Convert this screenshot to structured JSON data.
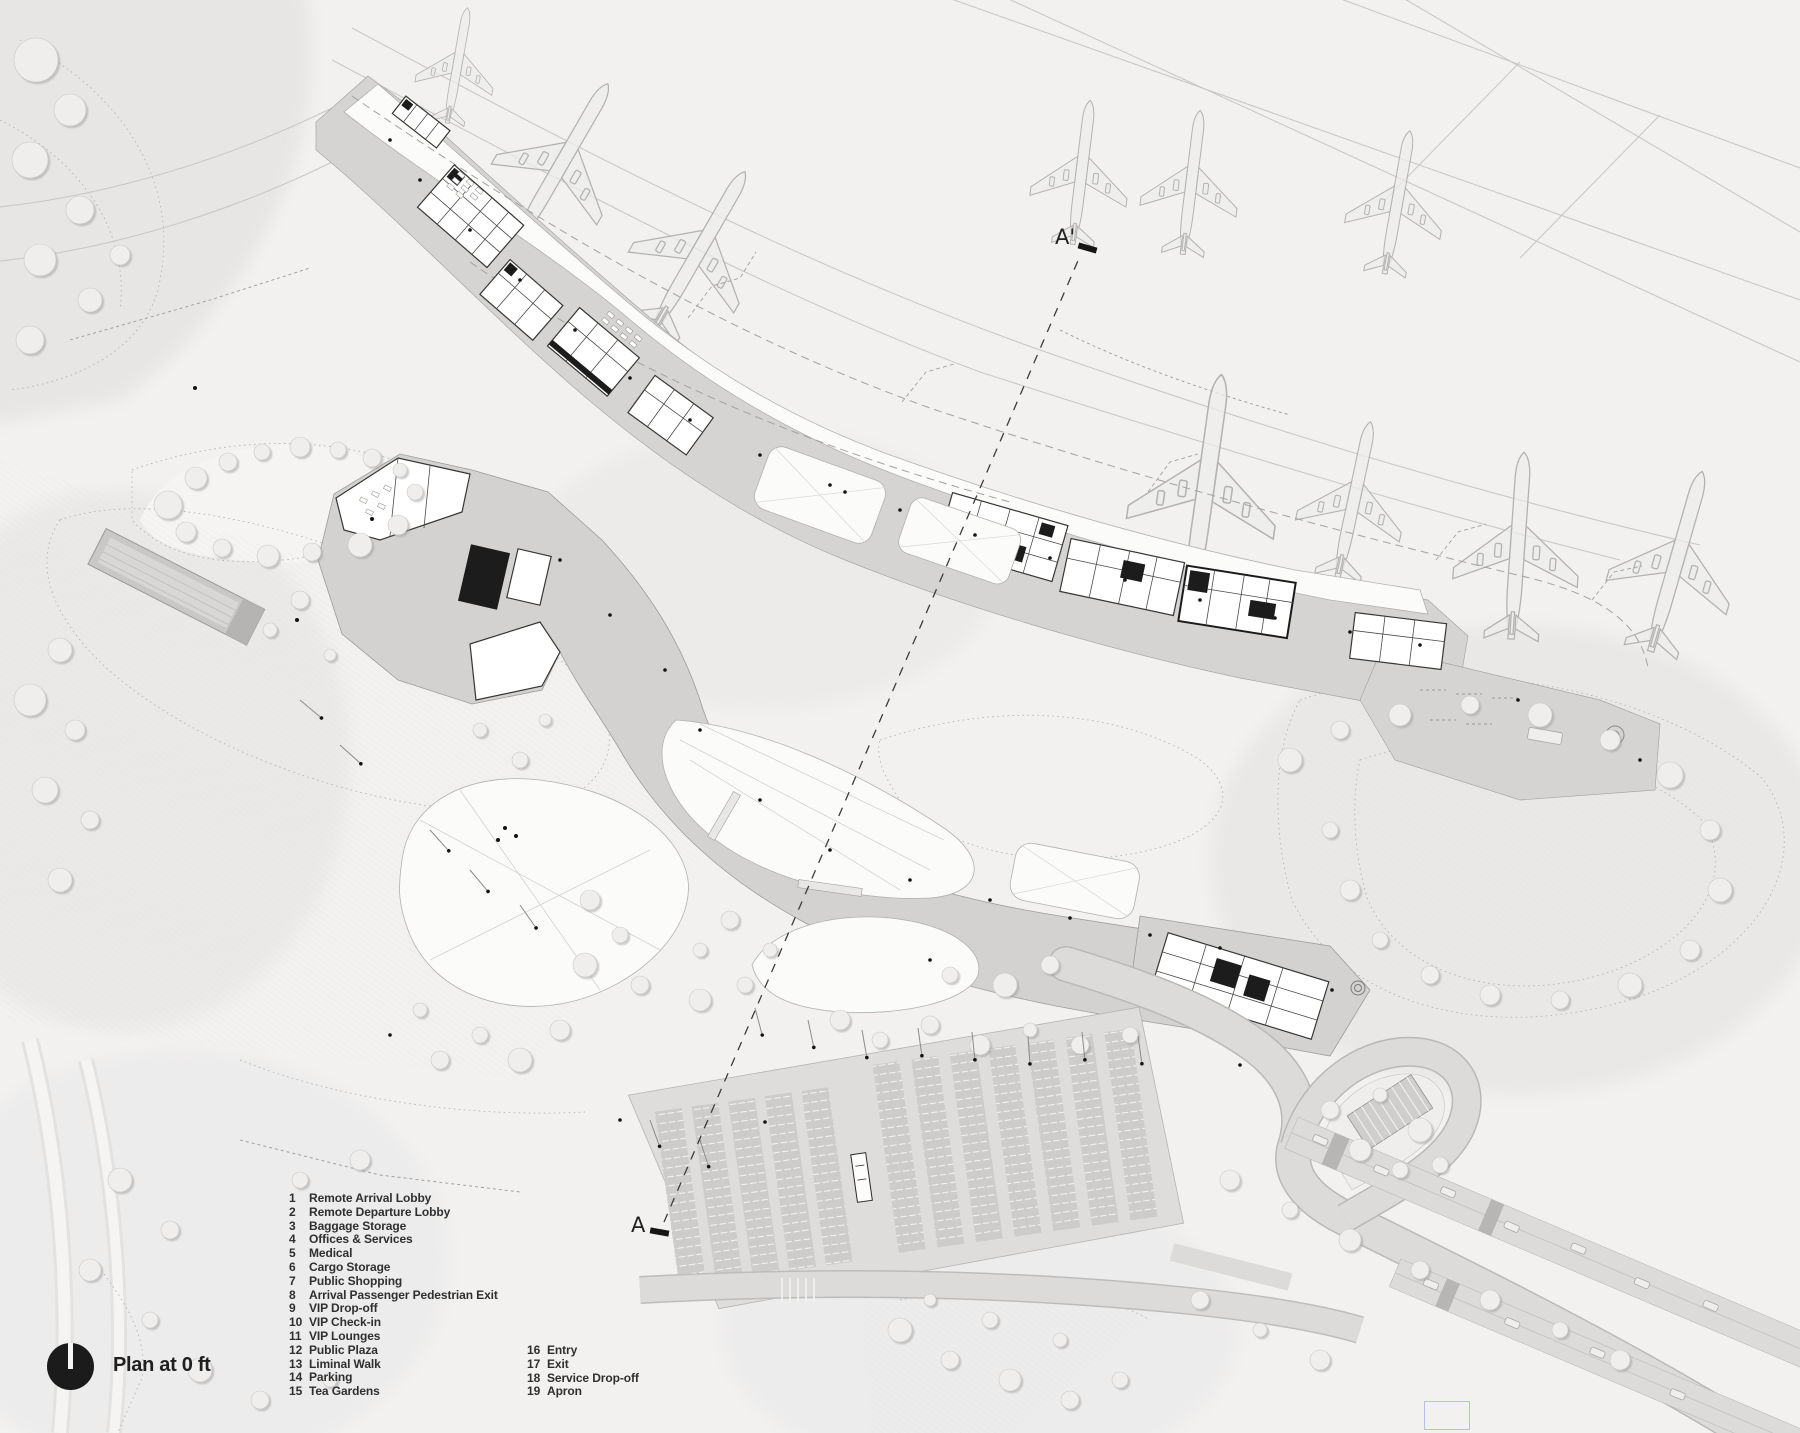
{
  "plan_label": "Plan at 0 ft",
  "section_markers": {
    "top": "A'",
    "bottom": "A"
  },
  "legend": {
    "column1": [
      {
        "num": "1",
        "label": "Remote Arrival Lobby"
      },
      {
        "num": "2",
        "label": "Remote Departure Lobby"
      },
      {
        "num": "3",
        "label": "Baggage Storage"
      },
      {
        "num": "4",
        "label": "Offices & Services"
      },
      {
        "num": "5",
        "label": "Medical"
      },
      {
        "num": "6",
        "label": "Cargo Storage"
      },
      {
        "num": "7",
        "label": "Public Shopping"
      },
      {
        "num": "8",
        "label": "Arrival Passenger Pedestrian Exit"
      },
      {
        "num": "9",
        "label": "VIP Drop-off"
      },
      {
        "num": "10",
        "label": "VIP Check-in"
      },
      {
        "num": "11",
        "label": "VIP Lounges"
      },
      {
        "num": "12",
        "label": "Public Plaza"
      },
      {
        "num": "13",
        "label": "Liminal Walk"
      },
      {
        "num": "14",
        "label": "Parking"
      },
      {
        "num": "15",
        "label": "Tea Gardens"
      }
    ],
    "column2": [
      {
        "num": "16",
        "label": "Entry"
      },
      {
        "num": "17",
        "label": "Exit"
      },
      {
        "num": "18",
        "label": "Service Drop-off"
      },
      {
        "num": "19",
        "label": "Apron"
      }
    ]
  },
  "icons": {
    "north_arrow": "north-arrow-icon",
    "airplane": "airplane-icon",
    "section_cut": "section-cut-marker"
  },
  "colors": {
    "paper": "#f2f1f0",
    "apron_deck": "#d5d4d3",
    "landside_deck": "#d3d2d1",
    "building_line": "#363636",
    "dark_core": "#1c1c1c",
    "text": "#2f2f2f",
    "selection_blue": "#b6bfe8"
  }
}
